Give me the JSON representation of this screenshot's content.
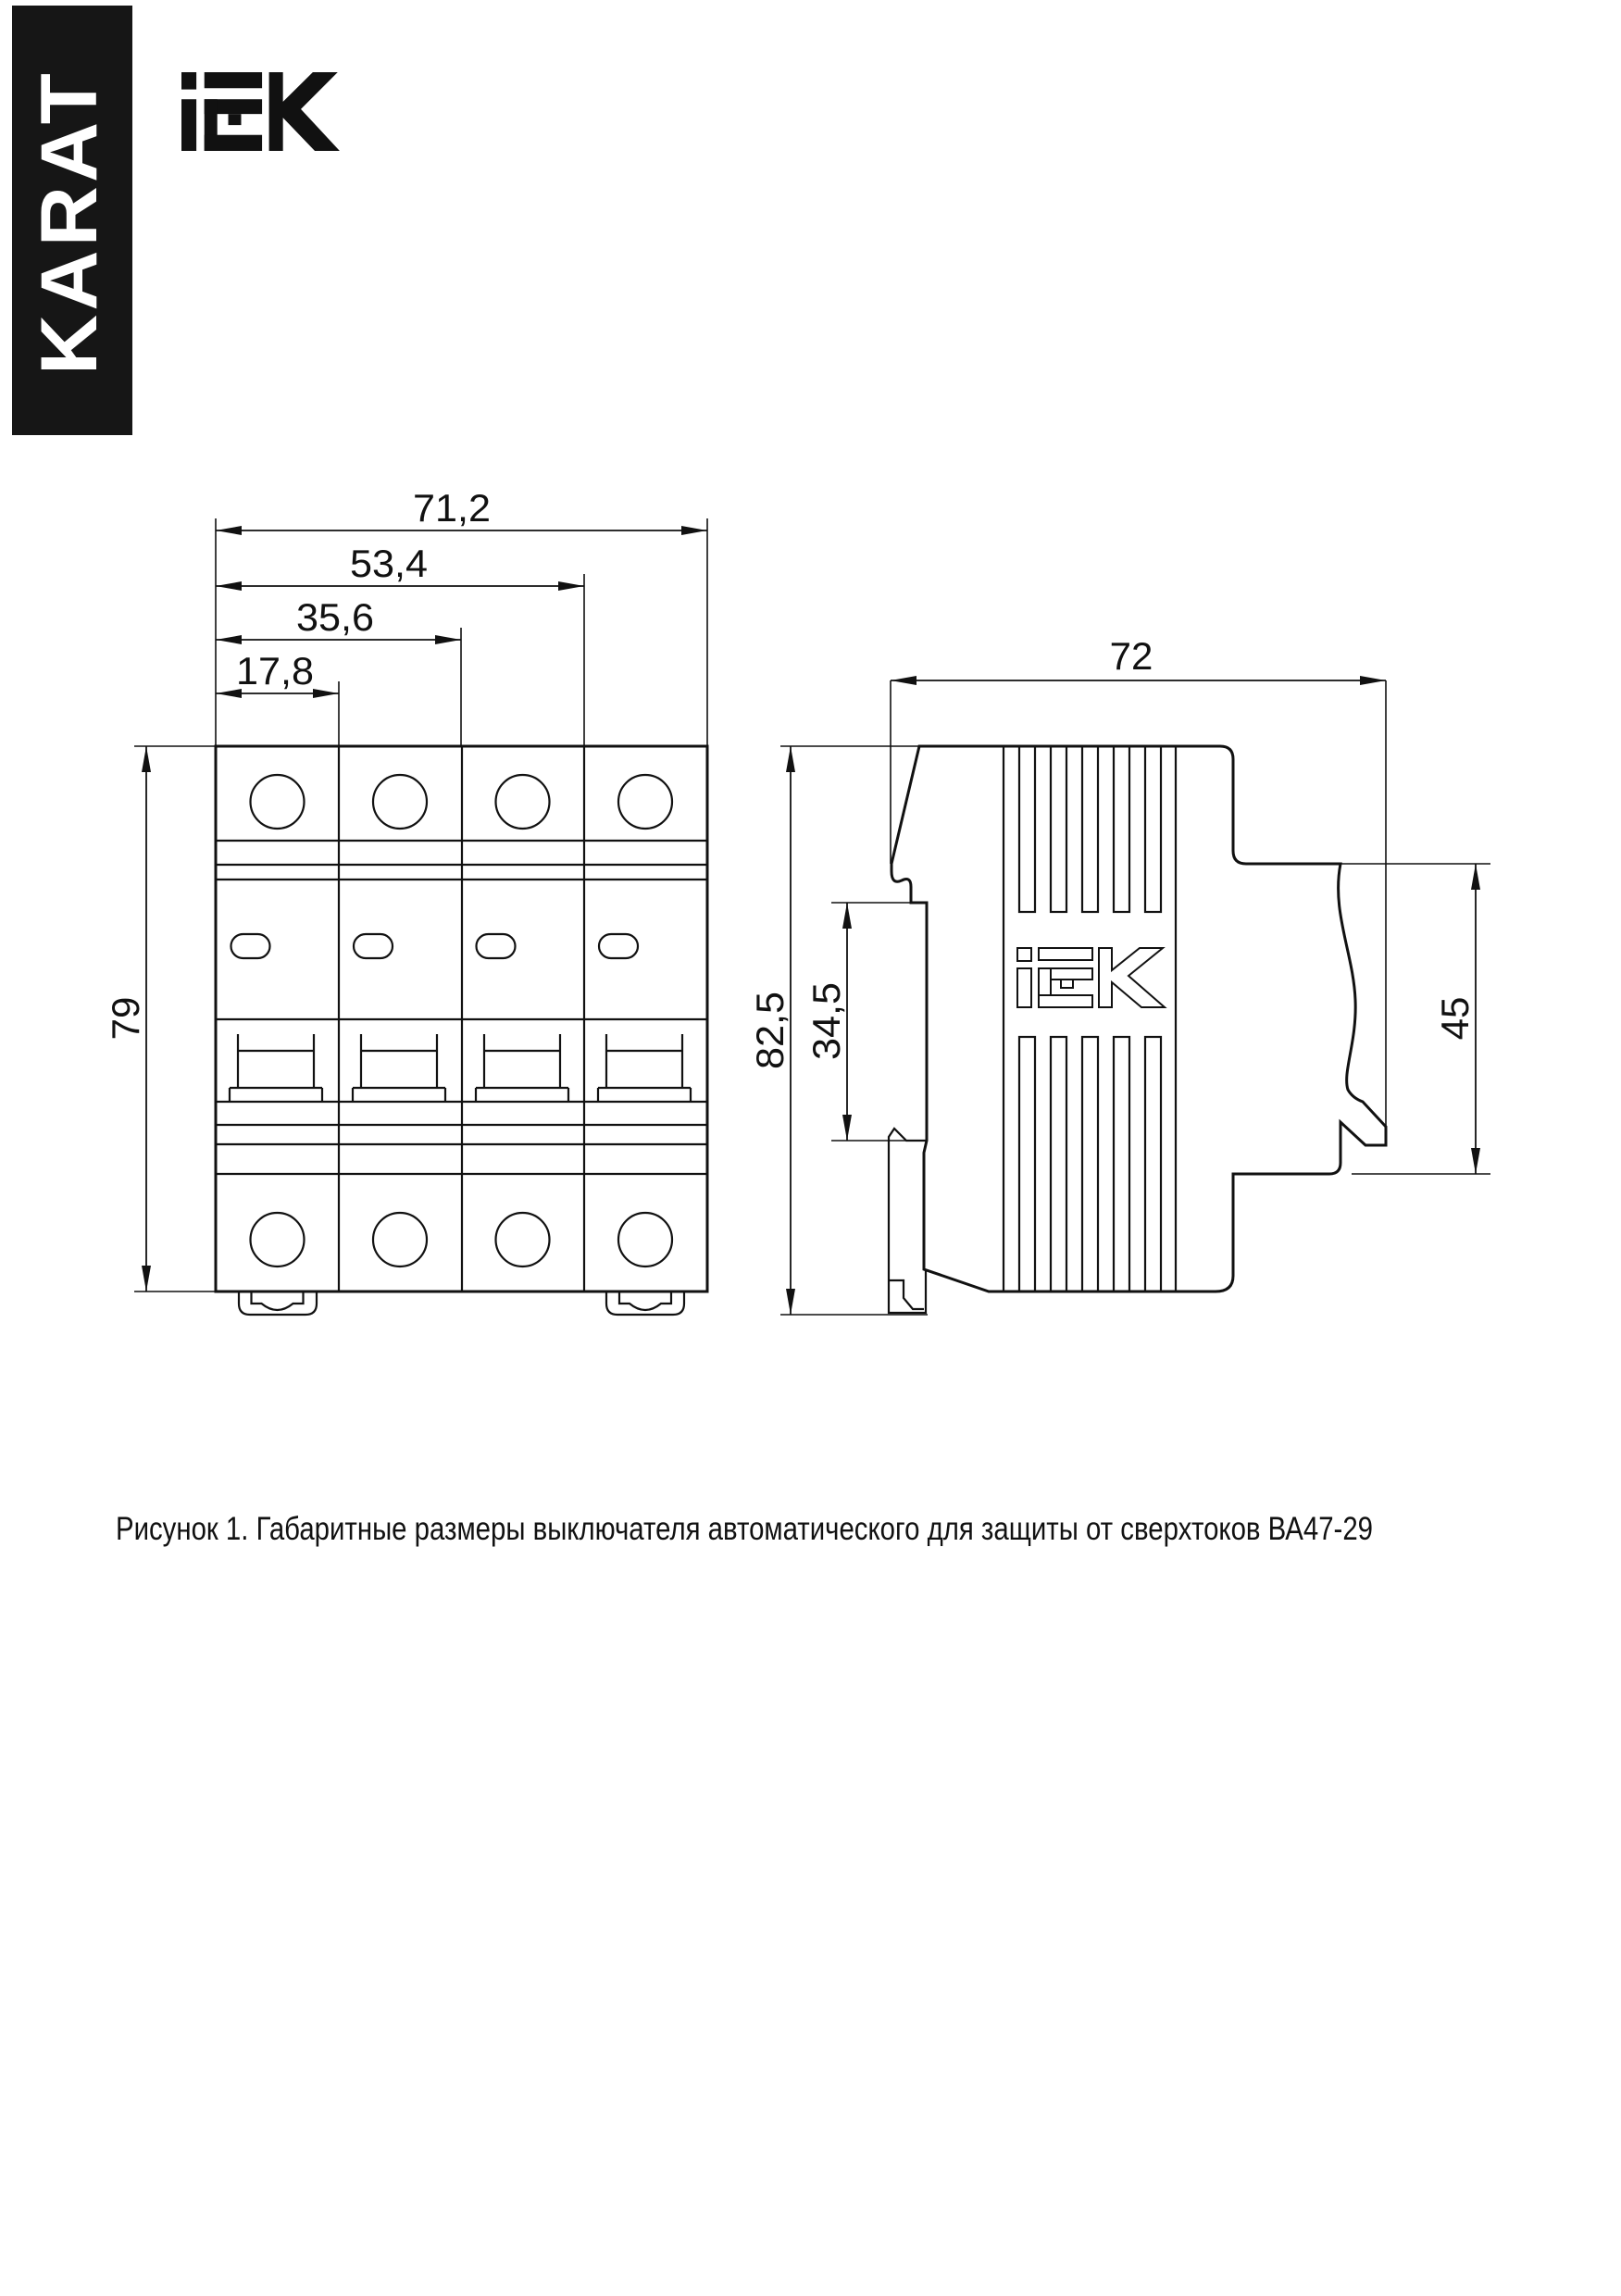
{
  "banner": {
    "text": "KARAT",
    "bg": "#161616",
    "fg": "#ffffff"
  },
  "brand": {
    "name": "IEK"
  },
  "figure": {
    "caption": "Рисунок 1. Габаритные размеры выключателя автоматического для защиты от сверхтоков ВА47-29",
    "product": "ВА47-29",
    "front_view": {
      "dims": {
        "width_total": "71,2",
        "width_3pole": "53,4",
        "width_2pole": "35,6",
        "width_1pole": "17,8",
        "height": "79"
      }
    },
    "side_view": {
      "dims": {
        "depth": "72",
        "height_total": "82,5",
        "din_slot": "34,5",
        "front_panel": "45"
      }
    }
  }
}
